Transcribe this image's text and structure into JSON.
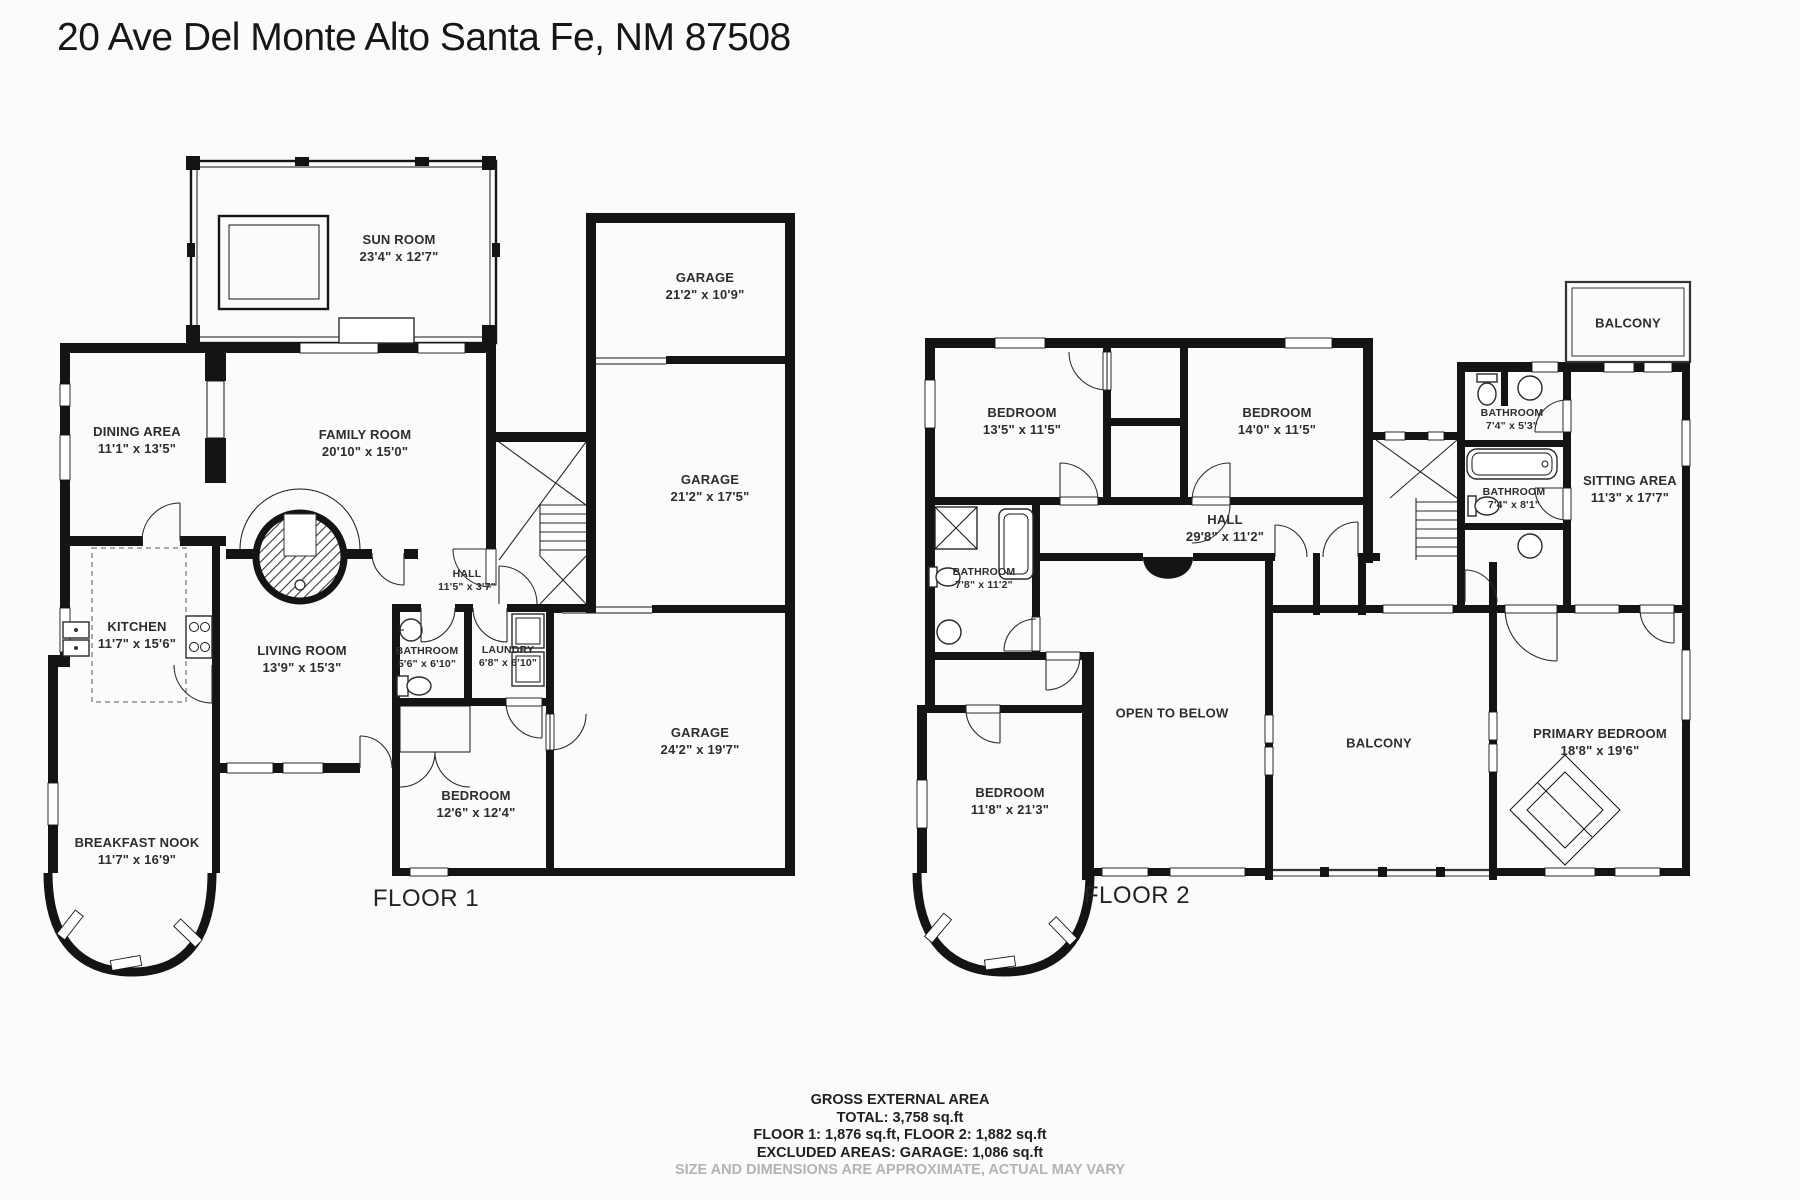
{
  "title": "20 Ave Del Monte Alto Santa Fe, NM 87508",
  "floor1": {
    "label": "FLOOR 1",
    "rooms": {
      "sunroom": {
        "name": "SUN ROOM",
        "dims": "23'4\" x 12'7\""
      },
      "garage_top": {
        "name": "GARAGE",
        "dims": "21'2\" x 10'9\""
      },
      "garage_mid": {
        "name": "GARAGE",
        "dims": "21'2\" x 17'5\""
      },
      "garage_main": {
        "name": "GARAGE",
        "dims": "24'2\" x 19'7\""
      },
      "dining": {
        "name": "DINING AREA",
        "dims": "11'1\" x 13'5\""
      },
      "family": {
        "name": "FAMILY ROOM",
        "dims": "20'10\" x 15'0\""
      },
      "hall": {
        "name": "HALL",
        "dims": "11'5\" x 3'7\""
      },
      "kitchen": {
        "name": "KITCHEN",
        "dims": "11'7\" x 15'6\""
      },
      "living": {
        "name": "LIVING ROOM",
        "dims": "13'9\" x 15'3\""
      },
      "bathroom": {
        "name": "BATHROOM",
        "dims": "5'6\" x 6'10\""
      },
      "laundry": {
        "name": "LAUNDRY",
        "dims": "6'8\" x 6'10\""
      },
      "bedroom": {
        "name": "BEDROOM",
        "dims": "12'6\" x 12'4\""
      },
      "nook": {
        "name": "BREAKFAST NOOK",
        "dims": "11'7\" x 16'9\""
      }
    }
  },
  "floor2": {
    "label": "FLOOR 2",
    "rooms": {
      "bedroom_left": {
        "name": "BEDROOM",
        "dims": "13'5\" x 11'5\""
      },
      "bedroom_right": {
        "name": "BEDROOM",
        "dims": "14'0\" x 11'5\""
      },
      "balcony_top": {
        "name": "BALCONY"
      },
      "bath_upper": {
        "name": "BATHROOM",
        "dims": "7'4\" x 5'3\""
      },
      "bath_lower": {
        "name": "BATHROOM",
        "dims": "7'4\" x 8'1\""
      },
      "sitting": {
        "name": "SITTING AREA",
        "dims": "11'3\" x 17'7\""
      },
      "hall": {
        "name": "HALL",
        "dims": "29'8\" x 11'2\""
      },
      "bathroom_west": {
        "name": "BATHROOM",
        "dims": "7'8\" x 11'2\""
      },
      "open_below": {
        "name": "OPEN TO BELOW"
      },
      "balcony_mid": {
        "name": "BALCONY"
      },
      "primary": {
        "name": "PRIMARY BEDROOM",
        "dims": "18'8\" x 19'6\""
      },
      "bedroom_bay": {
        "name": "BEDROOM",
        "dims": "11'8\" x 21'3\""
      }
    }
  },
  "footer": {
    "line1": "GROSS EXTERNAL AREA",
    "line2": "TOTAL: 3,758 sq.ft",
    "line3": "FLOOR 1: 1,876 sq.ft, FLOOR 2: 1,882 sq.ft",
    "line4": "EXCLUDED AREAS: GARAGE: 1,086 sq.ft",
    "line5": "SIZE AND DIMENSIONS ARE APPROXIMATE, ACTUAL MAY VARY"
  },
  "colors": {
    "wall": "#141414",
    "label": "#2d2d2d",
    "muted": "#b3b3b3"
  }
}
